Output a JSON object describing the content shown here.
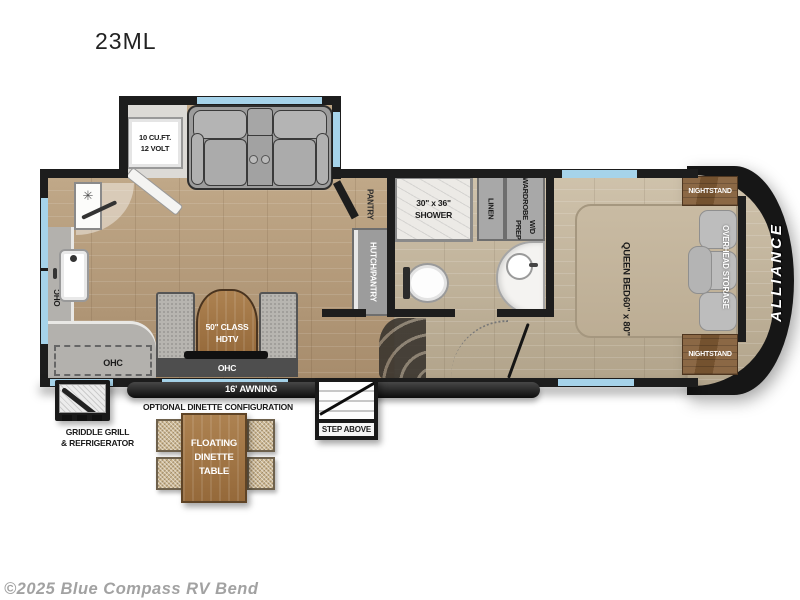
{
  "title": "23ML",
  "copyright": "©2025 Blue Compass RV Bend",
  "brand": "ALLIANCE",
  "colors": {
    "wall": "#1d1d1d",
    "window_blue": "#a6d3ea",
    "wood_living": "#b49a79",
    "wood_bedroom": "#c3b59d",
    "cabinet_gray": "#a8a8a8",
    "furniture_brown": "#a87c50",
    "fabric_beige": "#cdb893",
    "seat_gray": "#a9a9a9"
  },
  "labels": {
    "fridge": [
      "10 CU.FT.",
      "12 VOLT"
    ],
    "pantry": "PANTRY",
    "hutch": "HUTCH/PANTRY",
    "shower": [
      "30\" x 36\"",
      "SHOWER"
    ],
    "linen": "LINEN",
    "wardrobe": [
      "WARDROBE",
      "W/D PREP"
    ],
    "queen_bed": [
      "QUEEN BED",
      "60\" x 80\""
    ],
    "nightstand": "NIGHTSTAND",
    "overhead_storage": "OVERHEAD STORAGE",
    "tv": [
      "50\" CLASS",
      "HDTV"
    ],
    "ohc": "OHC",
    "awning": "16' AWNING",
    "step_above": "STEP ABOVE",
    "griddle": [
      "GRIDDLE GRILL",
      "& REFRIGERATOR"
    ],
    "optional_heading": "OPTIONAL DINETTE CONFIGURATION",
    "floating_table": [
      "FLOATING",
      "DINETTE",
      "TABLE"
    ]
  }
}
